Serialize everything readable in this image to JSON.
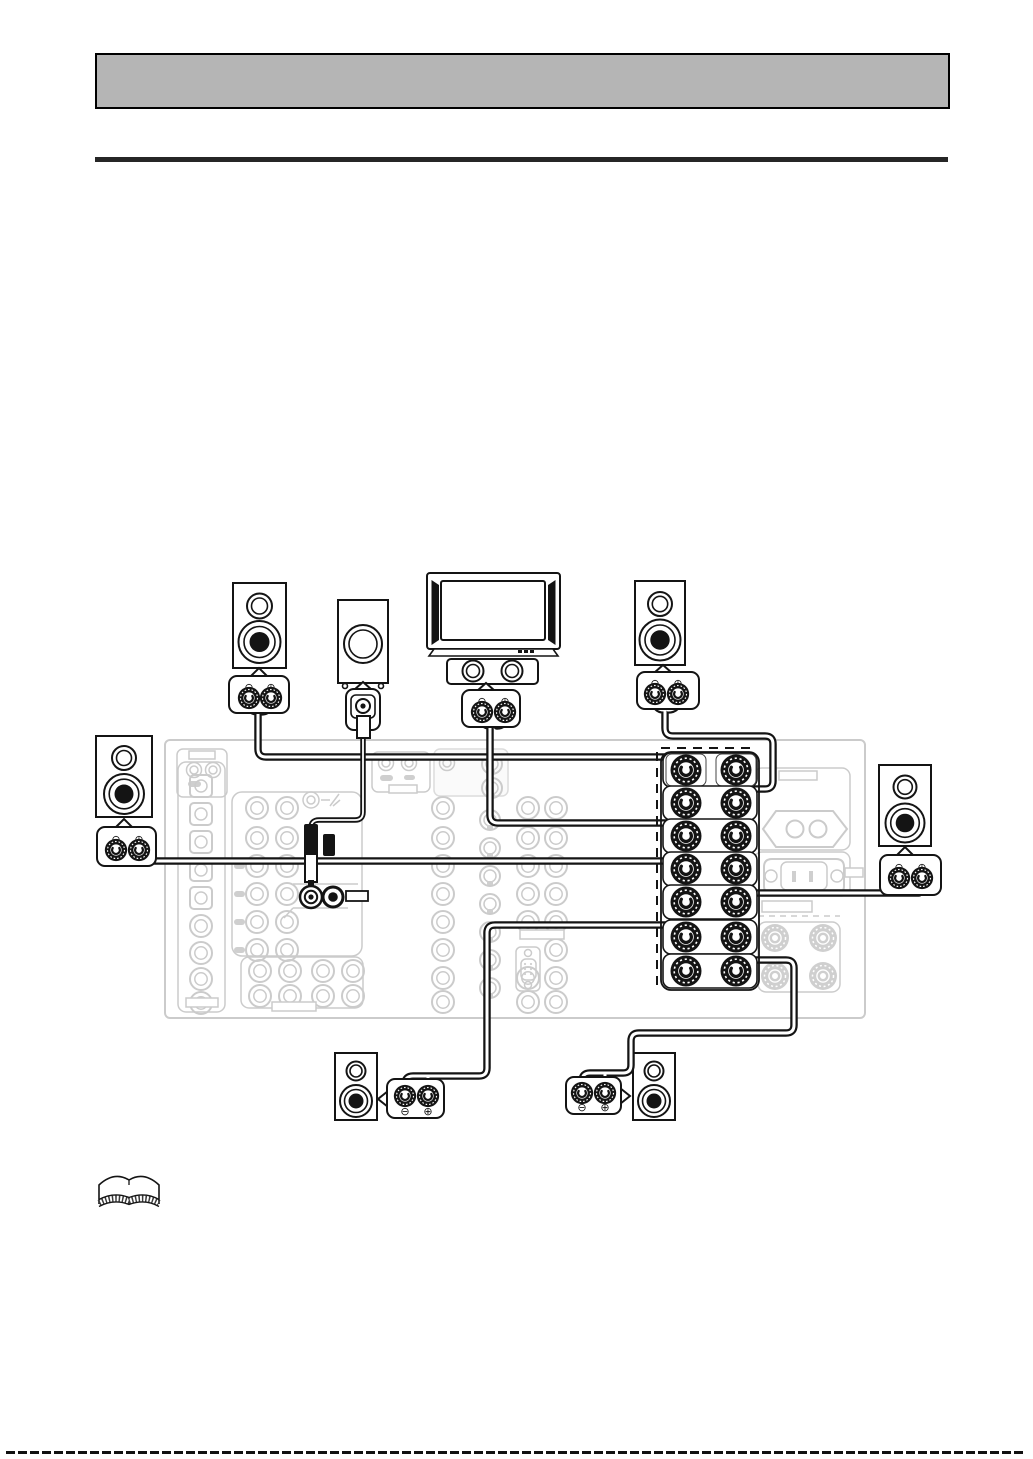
{
  "header": {
    "bar_color": "#b5b5b5"
  },
  "divider": {
    "color": "#262626"
  },
  "symbols": {
    "minus": "⊖",
    "plus": "⊕"
  },
  "colors": {
    "line": "#141414",
    "panel_gray": "#cbcbcb",
    "header_gray": "#b5b5b5",
    "cable": "#141414",
    "paper": "#ffffff"
  },
  "diagram": {
    "components": [
      "front-left-speaker",
      "subwoofer",
      "tv-monitor",
      "center-speaker",
      "front-right-speaker",
      "surround-left-speaker",
      "surround-right-speaker",
      "surround-back-left-speaker",
      "surround-back-right-speaker",
      "receiver-rear-panel",
      "speaker-terminal-block",
      "ac-outlet",
      "ac-inlet",
      "subwoofer-rca-plug"
    ],
    "speaker_terminal_rows": 7,
    "terminal_columns": 2,
    "callout_terminals": {
      "negative": "⊖",
      "positive": "⊕"
    }
  },
  "footer": {
    "icon": "open-book-icon"
  }
}
